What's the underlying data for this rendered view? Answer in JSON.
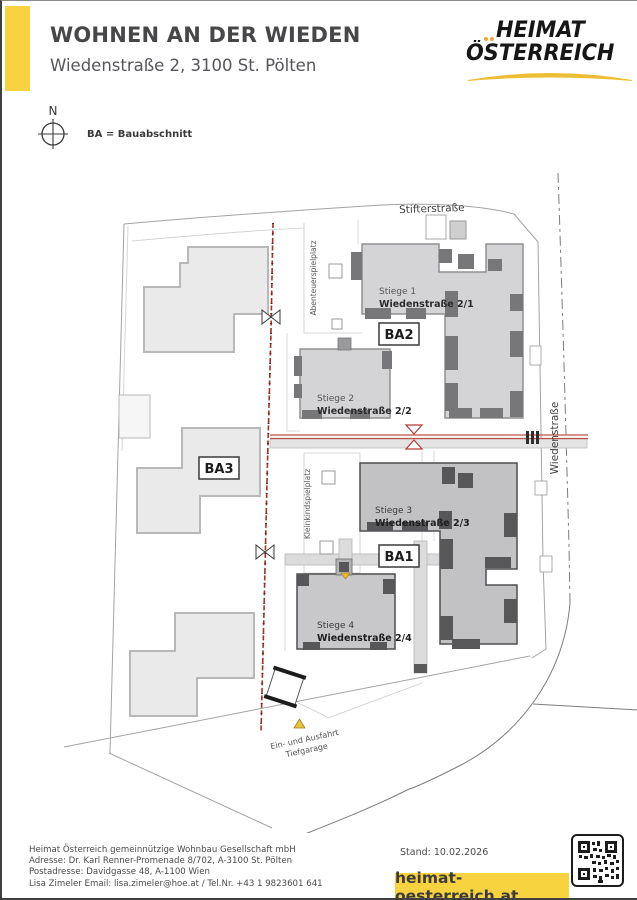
{
  "header": {
    "title": "WOHNEN AN DER WIEDEN",
    "subtitle": "Wiedenstraße 2, 3100 St. Pölten",
    "logo": {
      "line1": "HEIMAT",
      "line2": "ÖSTERREICH"
    }
  },
  "legend": {
    "north": "N",
    "ba_note": "BA = Bauabschnitt"
  },
  "map": {
    "streets": {
      "top": "Stifterstraße",
      "right": "Wiedenstraße"
    },
    "playgrounds": {
      "adventure": "Abenteuerspielplatz",
      "toddler": "Kleinkindspielplatz"
    },
    "buildings": {
      "stiege1": {
        "name": "Stiege 1",
        "address": "Wiedenstraße 2/1"
      },
      "stiege2": {
        "name": "Stiege 2",
        "address": "Wiedenstraße 2/2"
      },
      "stiege3": {
        "name": "Stiege 3",
        "address": "Wiedenstraße 2/3"
      },
      "stiege4": {
        "name": "Stiege 4",
        "address": "Wiedenstraße 2/4"
      }
    },
    "phases": {
      "ba1": "BA1",
      "ba2": "BA2",
      "ba3": "BA3"
    },
    "garage": {
      "line1": "Ein- und Ausfahrt",
      "line2": "Tiefgarage"
    }
  },
  "footer": {
    "company": "Heimat Österreich gemeinnützige Wohnbau Gesellschaft mbH",
    "address": "Adresse: Dr. Karl Renner-Promenade 8/702, A-3100 St. Pölten",
    "postal": "Postadresse: Davidgasse 48, A-1100 Wien",
    "contact": "Lisa Zimeler Email: lisa.zimeler@hoe.at / Tel.Nr. +43 1 9823601 641",
    "stand": "Stand: 10.02.2026",
    "website": "heimat-oesterreich.at"
  },
  "colors": {
    "accent_yellow": "#F7D43F",
    "phase_red": "#B23B34"
  }
}
